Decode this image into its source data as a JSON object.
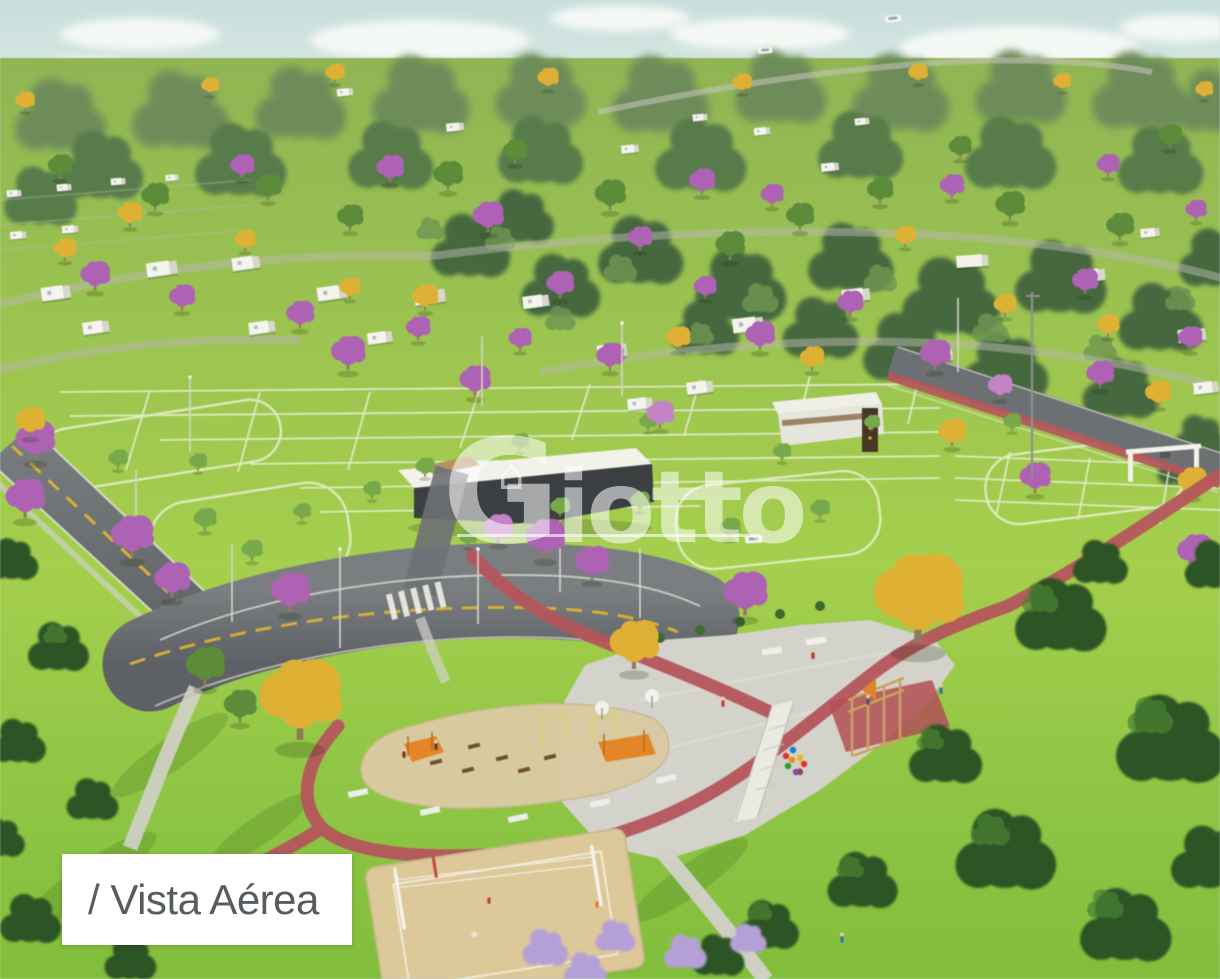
{
  "caption": {
    "text": "/ Vista Aérea"
  },
  "watermark": {
    "brand": "Giotto",
    "house_glyph": "⌂"
  },
  "scene_label": "aerial render of residential lot development with park and playground",
  "colors": {
    "sky_top": "#c9dedd",
    "sky_bottom": "#ecf2e7",
    "cloud": "#f8fbf7",
    "far_forest": "#6e8c5c",
    "dense_forest": "#47683f",
    "grass_hill": "#a6ce52",
    "grass_park": "#8cc148",
    "lot_line": "#eef3e0",
    "asphalt": "#63666a",
    "lane_yellow": "#d7b13c",
    "bike_path": "#b2575c",
    "plaza_concrete": "#d3d2cb",
    "playground_sand": "#d9caa4",
    "court_sand": "#dcc89c",
    "house_white": "#f3f3ee",
    "tree_purple": "#ab63b1",
    "tree_purple_light": "#c184c3",
    "tree_yellow": "#dcb13a",
    "tree_green": "#5d8a3c",
    "tree_dark": "#2f5326",
    "wood": "#c9a165",
    "play_orange": "#dd8630",
    "caption_bg": "#ffffff",
    "caption_text": "#575c61",
    "watermark_white": "rgba(255,255,255,0.55)"
  }
}
